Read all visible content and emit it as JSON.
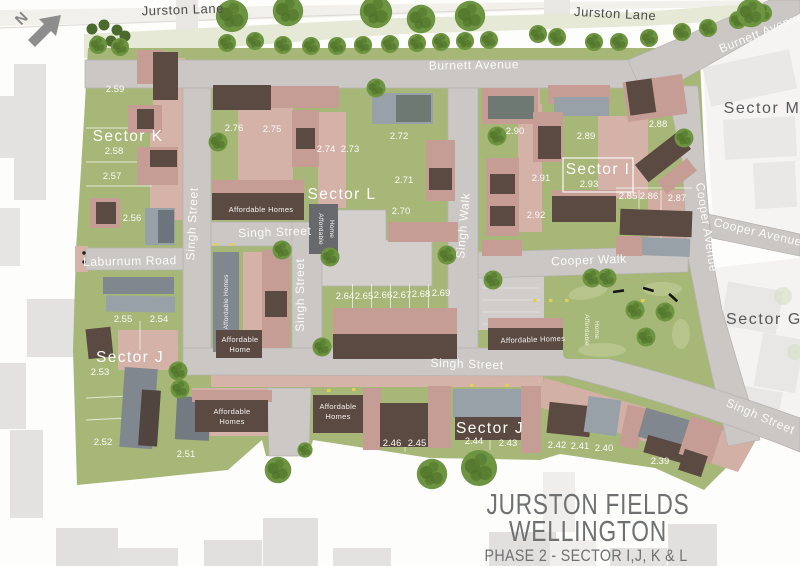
{
  "compass": {
    "north_label": "N"
  },
  "streets": {
    "jurston_lane_left": "Jurston Lane",
    "jurston_lane_right": "Jurston Lane",
    "burnett_avenue": "Burnett Avenue",
    "burnett_avenue_diagonal": "Burnett Avenue",
    "cooper_avenue_vertical": "Cooper Avenue",
    "cooper_avenue_horizontal": "Cooper Avenue",
    "cooper_walk": "Cooper Walk",
    "singh_street_left": "Singh Street",
    "singh_street_mid": "Singh Street",
    "singh_street_center": "Singh Street",
    "singh_walk": "Singh Walk",
    "singh_street_bottom": "Singh Street",
    "singh_street_diagonal": "Singh Street",
    "laburnum_road": "Laburnum Road"
  },
  "sectors": {
    "sector_k": "Sector K",
    "sector_l": "Sector L",
    "sector_i": "Sector I",
    "sector_i_plot": "2.93",
    "sector_j_left": "Sector J",
    "sector_j_bottom": "Sector J",
    "sector_m": "Sector M",
    "sector_g": "Sector G"
  },
  "affordable": {
    "l_terrace": "Affordable Homes",
    "l_west_vertical": "Affordable Homes",
    "center_badge_1": "Affordable",
    "center_badge_2": "Home",
    "j_mid_1": "Affordable",
    "j_mid_2": "Home",
    "cooper_walk_homes": "Affordable Homes",
    "cooper_badge_1": "Affordable",
    "cooper_badge_2": "Home",
    "j_south_west_1": "Affordable",
    "j_south_west_2": "Homes",
    "j_south_mid_1": "Affordable",
    "j_south_mid_2": "Homes"
  },
  "plots": [
    {
      "label": "2.59",
      "x": 115,
      "y": 92
    },
    {
      "label": "2.58",
      "x": 114,
      "y": 154
    },
    {
      "label": "2.57",
      "x": 112,
      "y": 179
    },
    {
      "label": "2.56",
      "x": 132,
      "y": 221
    },
    {
      "label": "2.76",
      "x": 234,
      "y": 131
    },
    {
      "label": "2.75",
      "x": 272,
      "y": 132
    },
    {
      "label": "2.74",
      "x": 326,
      "y": 152
    },
    {
      "label": "2.73",
      "x": 350,
      "y": 152
    },
    {
      "label": "2.72",
      "x": 399,
      "y": 139
    },
    {
      "label": "2.71",
      "x": 404,
      "y": 183
    },
    {
      "label": "2.70",
      "x": 401,
      "y": 214
    },
    {
      "label": "2.64",
      "x": 345,
      "y": 299
    },
    {
      "label": "2.65",
      "x": 364,
      "y": 299
    },
    {
      "label": "2.66",
      "x": 383,
      "y": 298
    },
    {
      "label": "2.67",
      "x": 402,
      "y": 298
    },
    {
      "label": "2.68",
      "x": 421,
      "y": 297
    },
    {
      "label": "2.69",
      "x": 441,
      "y": 296
    },
    {
      "label": "2.90",
      "x": 515,
      "y": 134
    },
    {
      "label": "2.89",
      "x": 586,
      "y": 139
    },
    {
      "label": "2.88",
      "x": 658,
      "y": 127
    },
    {
      "label": "2.91",
      "x": 541,
      "y": 181
    },
    {
      "label": "2.92",
      "x": 536,
      "y": 218
    },
    {
      "label": "2.85",
      "x": 628,
      "y": 199
    },
    {
      "label": "2.86",
      "x": 649,
      "y": 199
    },
    {
      "label": "2.87",
      "x": 677,
      "y": 201
    },
    {
      "label": "2.55",
      "x": 123,
      "y": 322
    },
    {
      "label": "2.54",
      "x": 159,
      "y": 322
    },
    {
      "label": "2.53",
      "x": 100,
      "y": 375
    },
    {
      "label": "2.52",
      "x": 103,
      "y": 445
    },
    {
      "label": "2.51",
      "x": 186,
      "y": 457
    },
    {
      "label": "2.46",
      "x": 392,
      "y": 446
    },
    {
      "label": "2.45",
      "x": 417,
      "y": 446
    },
    {
      "label": "2.44",
      "x": 474,
      "y": 444
    },
    {
      "label": "2.43",
      "x": 508,
      "y": 446
    },
    {
      "label": "2.42",
      "x": 557,
      "y": 448
    },
    {
      "label": "2.41",
      "x": 580,
      "y": 449
    },
    {
      "label": "2.40",
      "x": 604,
      "y": 451
    },
    {
      "label": "2.39",
      "x": 660,
      "y": 464
    }
  ],
  "title_block": {
    "line1": "JURSTON FIELDS",
    "line2": "WELLINGTON",
    "line3": "PHASE 2 - SECTOR I,J, K & L"
  },
  "colors": {
    "site_green": "#a7b778",
    "road_gray": "#cac7c4",
    "roof_pink": "#c59d95",
    "roof_dark_brown": "#5a4a42",
    "roof_gray": "#81878f",
    "title_gray": "#6f7072"
  }
}
